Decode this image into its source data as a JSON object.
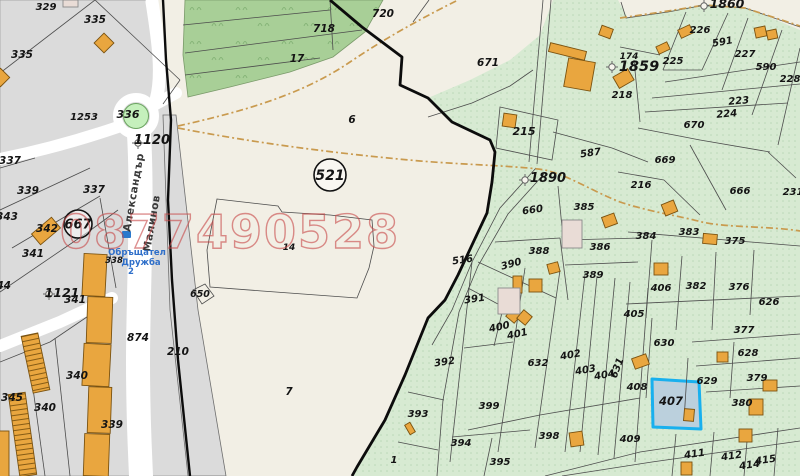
{
  "watermark": "0877490528",
  "streets": {
    "name1": "Александър",
    "name2": "Малинов"
  },
  "info_note": {
    "line1": "Обръщател",
    "line2": "Дружба",
    "line3": "2"
  },
  "colors": {
    "open_land": "#f2efe5",
    "urban_block": "#dbdbdb",
    "road": "#ffffff",
    "forest": "#a8cf97",
    "farm_green": "#d7ead2",
    "building": "#e9a63f",
    "highlight_stroke": "#19b0ee",
    "highlight_fill": "#b9cfdd",
    "watermark_red": "#c84b4b",
    "path_tan": "#c99a4e",
    "info_blue": "#2f6fc9"
  },
  "map": {
    "highlight_parcel": {
      "id": "407",
      "points": "652,379 699,382 701,429 653,427"
    },
    "circled": [
      [
        "667",
        78,
        224,
        14,
        13
      ],
      [
        "521",
        330,
        175,
        16,
        14
      ]
    ],
    "markers": [
      [
        138,
        143
      ],
      [
        49,
        294
      ],
      [
        525,
        180
      ],
      [
        704,
        6
      ],
      [
        612,
        67
      ]
    ],
    "labels": [
      [
        "329",
        46,
        10,
        10,
        0
      ],
      [
        "335",
        95,
        23,
        10.5,
        0
      ],
      [
        "335",
        22,
        58,
        10.5,
        0
      ],
      [
        "336",
        128,
        118,
        11,
        0
      ],
      [
        "1253",
        84,
        120,
        10,
        0
      ],
      [
        "1120",
        152,
        144,
        13,
        0
      ],
      [
        "337",
        10,
        164,
        10.5,
        0
      ],
      [
        "339",
        28,
        194,
        10.5,
        0
      ],
      [
        "337",
        94,
        193,
        10.5,
        0
      ],
      [
        "343",
        7,
        220,
        10.5,
        0
      ],
      [
        "342",
        47,
        232,
        10.5,
        0
      ],
      [
        "341",
        33,
        257,
        10.5,
        0
      ],
      [
        "344",
        0,
        289,
        10.5,
        0
      ],
      [
        "1121",
        62,
        297,
        12.5,
        0
      ],
      [
        "341",
        75,
        303,
        10.5,
        0
      ],
      [
        "338",
        114,
        263,
        8.5,
        0
      ],
      [
        "874",
        138,
        341,
        10.5,
        0
      ],
      [
        "210",
        178,
        355,
        10.5,
        0
      ],
      [
        "345",
        12,
        401,
        10.5,
        0
      ],
      [
        "340",
        45,
        411,
        10.5,
        0
      ],
      [
        "340",
        77,
        379,
        10.5,
        0
      ],
      [
        "339",
        112,
        428,
        10.5,
        0
      ],
      [
        "720",
        383,
        17,
        10.5,
        0
      ],
      [
        "718",
        324,
        32,
        10.5,
        0
      ],
      [
        "17",
        297,
        62,
        10.5,
        0
      ],
      [
        "6",
        352,
        123,
        10.5,
        0
      ],
      [
        "671",
        488,
        66,
        10.5,
        0
      ],
      [
        "14",
        289,
        250,
        9,
        0
      ],
      [
        "650",
        200,
        297,
        9.5,
        0
      ],
      [
        "7",
        289,
        395,
        10.5,
        0
      ],
      [
        "1860",
        727,
        8,
        12.5,
        0
      ],
      [
        "226",
        700,
        33,
        10,
        0
      ],
      [
        "591",
        723,
        45,
        10,
        -10
      ],
      [
        "227",
        745,
        57,
        10,
        0
      ],
      [
        "590",
        766,
        70,
        10,
        0
      ],
      [
        "228",
        790,
        82,
        10,
        0
      ],
      [
        "225",
        673,
        64,
        10,
        0
      ],
      [
        "174",
        629,
        59,
        9,
        0
      ],
      [
        "1859",
        639,
        71,
        14.5,
        0
      ],
      [
        "218",
        622,
        98,
        10,
        0
      ],
      [
        "215",
        524,
        135,
        11,
        0
      ],
      [
        "223",
        739,
        104,
        10,
        -5
      ],
      [
        "224",
        727,
        117,
        10,
        -5
      ],
      [
        "670",
        694,
        128,
        10,
        0
      ],
      [
        "587",
        591,
        156,
        10,
        -8
      ],
      [
        "1890",
        548,
        182,
        13,
        0
      ],
      [
        "669",
        665,
        163,
        10,
        0
      ],
      [
        "216",
        641,
        188,
        10,
        0
      ],
      [
        "666",
        740,
        194,
        10,
        0
      ],
      [
        "231",
        793,
        195,
        10,
        0
      ],
      [
        "660",
        533,
        213,
        10,
        -8
      ],
      [
        "385",
        584,
        210,
        10,
        0
      ],
      [
        "384",
        646,
        239,
        10,
        0
      ],
      [
        "383",
        689,
        235,
        10,
        0
      ],
      [
        "375",
        735,
        244,
        10,
        0
      ],
      [
        "386",
        600,
        250,
        10,
        0
      ],
      [
        "388",
        539,
        254,
        10,
        0
      ],
      [
        "516",
        463,
        263,
        10,
        -8
      ],
      [
        "390",
        512,
        267,
        10,
        -15
      ],
      [
        "389",
        593,
        278,
        10,
        0
      ],
      [
        "391",
        475,
        302,
        10,
        -8
      ],
      [
        "406",
        661,
        291,
        10,
        0
      ],
      [
        "382",
        696,
        289,
        10,
        0
      ],
      [
        "376",
        739,
        290,
        10,
        0
      ],
      [
        "626",
        769,
        305,
        10,
        0
      ],
      [
        "405",
        634,
        317,
        10,
        0
      ],
      [
        "377",
        744,
        333,
        10,
        0
      ],
      [
        "630",
        664,
        346,
        10,
        0
      ],
      [
        "628",
        748,
        356,
        10,
        0
      ],
      [
        "400",
        500,
        330,
        10,
        -12
      ],
      [
        "401",
        518,
        337,
        10,
        -12
      ],
      [
        "632",
        538,
        366,
        10,
        0
      ],
      [
        "402",
        571,
        358,
        10,
        -10
      ],
      [
        "403",
        586,
        373,
        10,
        -10
      ],
      [
        "404",
        605,
        378,
        10,
        -10
      ],
      [
        "631",
        620,
        369,
        10,
        -70
      ],
      [
        "408",
        637,
        390,
        10,
        0
      ],
      [
        "629",
        707,
        384,
        10,
        0
      ],
      [
        "379",
        757,
        381,
        10,
        0
      ],
      [
        "407",
        671,
        405,
        11.5,
        0
      ],
      [
        "380",
        742,
        406,
        10,
        0
      ],
      [
        "392",
        445,
        365,
        10,
        -8
      ],
      [
        "399",
        489,
        409,
        10,
        0
      ],
      [
        "393",
        418,
        417,
        10,
        0
      ],
      [
        "394",
        461,
        446,
        10,
        0
      ],
      [
        "395",
        500,
        465,
        10,
        0
      ],
      [
        "398",
        549,
        439,
        10,
        0
      ],
      [
        "409",
        630,
        442,
        10,
        0
      ],
      [
        "1",
        394,
        463,
        10,
        0
      ],
      [
        "411",
        695,
        457,
        10,
        -8
      ],
      [
        "412",
        732,
        459,
        10,
        -8
      ],
      [
        "414",
        750,
        468,
        10,
        -8
      ],
      [
        "415",
        766,
        463,
        10,
        -8
      ]
    ],
    "buildings": {
      "orange": [
        [
          97,
          36,
          14,
          14,
          45
        ],
        [
          -6,
          71,
          13,
          13,
          45
        ],
        [
          33,
          224,
          26,
          14,
          -40
        ],
        [
          600,
          27,
          12,
          10,
          20
        ],
        [
          679,
          27,
          13,
          9,
          -25
        ],
        [
          755,
          27,
          11,
          10,
          -12
        ],
        [
          767,
          30,
          10,
          9,
          -12
        ],
        [
          657,
          44,
          12,
          8,
          -25
        ],
        [
          615,
          72,
          17,
          13,
          -30
        ],
        [
          549,
          47,
          37,
          9,
          14
        ],
        [
          566,
          60,
          27,
          29,
          10
        ],
        [
          503,
          114,
          13,
          13,
          8
        ],
        [
          567,
          227,
          13,
          11,
          0
        ],
        [
          603,
          215,
          13,
          11,
          -20
        ],
        [
          548,
          263,
          11,
          10,
          -15
        ],
        [
          663,
          202,
          13,
          12,
          -22
        ],
        [
          703,
          234,
          14,
          10,
          5
        ],
        [
          654,
          263,
          14,
          12,
          0
        ],
        [
          513,
          276,
          9,
          17,
          0
        ],
        [
          529,
          279,
          13,
          13,
          0
        ],
        [
          508,
          310,
          11,
          11,
          40
        ],
        [
          519,
          312,
          11,
          11,
          40
        ],
        [
          570,
          432,
          13,
          14,
          -8
        ],
        [
          633,
          356,
          15,
          11,
          -20
        ],
        [
          717,
          352,
          11,
          10,
          0
        ],
        [
          763,
          380,
          14,
          11,
          0
        ],
        [
          749,
          399,
          14,
          16,
          0
        ],
        [
          684,
          409,
          10,
          12,
          5
        ],
        [
          739,
          429,
          13,
          13,
          0
        ],
        [
          681,
          462,
          11,
          13,
          0
        ],
        [
          407,
          423,
          6,
          11,
          -30
        ],
        [
          83,
          254,
          23,
          42,
          3
        ],
        [
          87,
          297,
          25,
          46,
          2
        ],
        [
          83,
          344,
          27,
          42,
          3
        ],
        [
          88,
          387,
          23,
          46,
          2
        ],
        [
          84,
          434,
          25,
          42,
          2
        ],
        [
          -5,
          431,
          14,
          46,
          0
        ]
      ],
      "pink": [
        [
          63,
          0,
          15,
          7,
          0
        ],
        [
          562,
          220,
          20,
          28,
          0
        ],
        [
          498,
          288,
          22,
          26,
          0
        ]
      ],
      "ladder": [
        [
          27,
          334,
          17,
          58,
          -12
        ],
        [
          14,
          393,
          17,
          83,
          -8
        ]
      ]
    },
    "lines": [
      [
        0,
        73,
        95,
        0
      ],
      [
        95,
        0,
        180,
        80
      ],
      [
        180,
        80,
        163,
        104
      ],
      [
        0,
        168,
        35,
        158
      ],
      [
        0,
        210,
        90,
        168
      ],
      [
        12,
        248,
        100,
        196
      ],
      [
        0,
        292,
        88,
        232
      ],
      [
        88,
        232,
        118,
        210
      ],
      [
        100,
        198,
        116,
        288
      ],
      [
        28,
        352,
        45,
        476
      ],
      [
        55,
        338,
        70,
        476
      ],
      [
        0,
        362,
        50,
        342
      ],
      [
        50,
        342,
        112,
        300
      ],
      [
        183,
        25,
        330,
        10
      ],
      [
        185,
        53,
        362,
        30
      ],
      [
        330,
        0,
        333,
        50
      ],
      [
        185,
        75,
        320,
        58
      ],
      [
        429,
        0,
        413,
        22
      ],
      [
        686,
        12,
        663,
        70
      ],
      [
        728,
        13,
        702,
        70
      ],
      [
        748,
        18,
        722,
        90
      ],
      [
        782,
        30,
        752,
        115
      ],
      [
        800,
        48,
        778,
        145
      ],
      [
        620,
        47,
        660,
        55
      ],
      [
        634,
        60,
        640,
        122
      ],
      [
        663,
        70,
        702,
        70
      ],
      [
        665,
        82,
        800,
        62
      ],
      [
        652,
        98,
        800,
        84
      ],
      [
        645,
        112,
        788,
        103
      ],
      [
        638,
        128,
        700,
        140
      ],
      [
        700,
        140,
        770,
        152
      ],
      [
        553,
        132,
        612,
        148
      ],
      [
        612,
        148,
        648,
        162
      ],
      [
        558,
        186,
        564,
        248
      ],
      [
        565,
        240,
        640,
        238
      ],
      [
        565,
        265,
        638,
        262
      ],
      [
        560,
        238,
        568,
        300
      ],
      [
        495,
        242,
        560,
        238
      ],
      [
        478,
        262,
        556,
        298
      ],
      [
        468,
        288,
        524,
        318
      ],
      [
        628,
        232,
        800,
        246
      ],
      [
        652,
        240,
        646,
        318
      ],
      [
        682,
        256,
        676,
        330
      ],
      [
        716,
        252,
        712,
        330
      ],
      [
        754,
        250,
        750,
        315
      ],
      [
        626,
        304,
        800,
        296
      ],
      [
        652,
        318,
        646,
        398
      ],
      [
        688,
        358,
        684,
        420
      ],
      [
        692,
        342,
        800,
        334
      ],
      [
        696,
        366,
        800,
        358
      ],
      [
        734,
        342,
        730,
        398
      ],
      [
        706,
        392,
        800,
        386
      ],
      [
        472,
        262,
        450,
        462
      ],
      [
        525,
        268,
        498,
        452
      ],
      [
        505,
        300,
        494,
        346
      ],
      [
        464,
        348,
        513,
        342
      ],
      [
        560,
        270,
        535,
        448
      ],
      [
        585,
        274,
        565,
        452
      ],
      [
        597,
        276,
        580,
        452
      ],
      [
        615,
        278,
        598,
        455
      ],
      [
        630,
        282,
        614,
        458
      ],
      [
        648,
        288,
        635,
        462
      ],
      [
        468,
        430,
        540,
        415
      ],
      [
        540,
        415,
        640,
        398
      ],
      [
        452,
        437,
        530,
        430
      ],
      [
        484,
        476,
        492,
        438
      ],
      [
        408,
        392,
        444,
        400
      ],
      [
        398,
        442,
        438,
        450
      ],
      [
        676,
        434,
        672,
        476
      ],
      [
        714,
        432,
        710,
        476
      ],
      [
        748,
        430,
        744,
        476
      ],
      [
        778,
        428,
        774,
        476
      ],
      [
        690,
        145,
        726,
        210
      ],
      [
        618,
        172,
        664,
        180
      ],
      [
        664,
        180,
        700,
        215
      ],
      [
        768,
        152,
        796,
        178
      ]
    ],
    "paths": [
      "M536,168 L500,208 472,262 452,310 432,345",
      "M544,174 L508,214 478,266 459,312 443,400 437,476",
      "M545,476 L640,452 800,428",
      "M562,476 L652,462 800,441",
      "M621,2 L626,18 668,12 705,5 745,8 800,27",
      "M543,0 L529,162",
      "M551,0 L537,164",
      "M428,117 L472,103 510,86 533,70",
      "M217,199 L278,206 282,212 330,215 372,220 374,246 369,268 357,298 262,291 210,287 207,250 Z",
      "M500,107 L558,120 552,160 496,148 Z",
      "M193,290 L205,284 214,296 202,304 Z"
    ],
    "dashdot": [
      "M178,126 C240,112 300,96 350,62 C390,35 430,14 458,0",
      "M178,128 C250,142 330,153 420,161 C470,165 520,166 545,170 C570,176 590,190 620,202 C650,212 680,216 702,222 C730,228 770,226 800,231",
      "M620,18 L668,11 705,5 745,8 800,26"
    ]
  }
}
